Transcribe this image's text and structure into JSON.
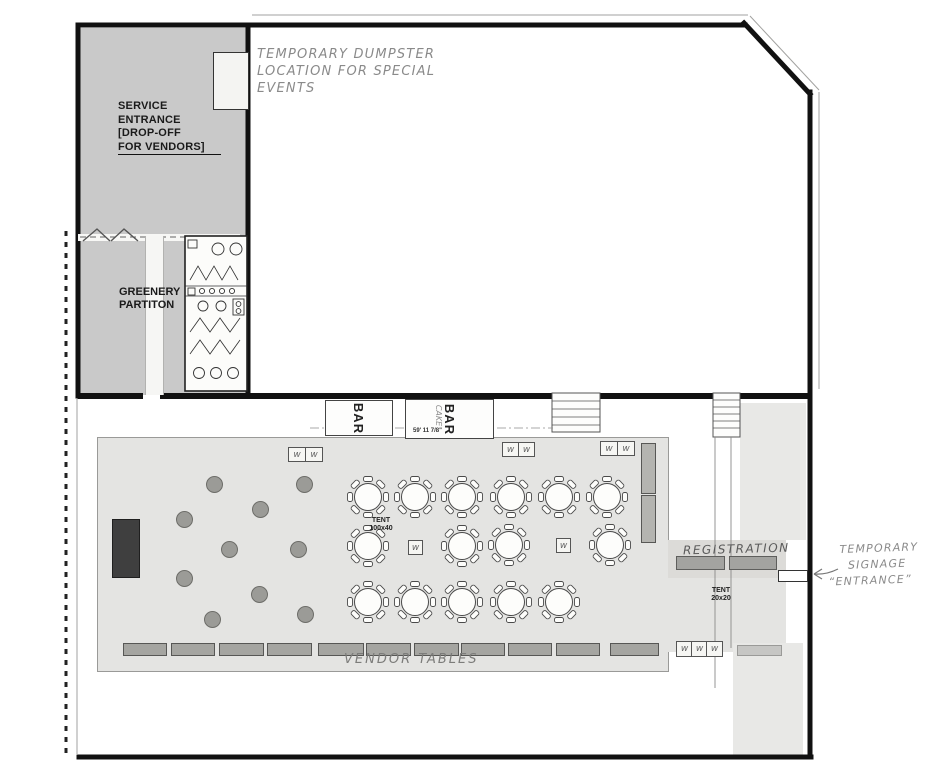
{
  "labels": {
    "service_entrance_lines": [
      "SERVICE",
      "ENTRANCE",
      "[DROP-OFF",
      "FOR VENDORS]"
    ],
    "greenery_lines": [
      "GREENERY",
      "PARTITON"
    ],
    "dumpster_note_lines": [
      "TEMPORARY DUMPSTER",
      "LOCATION FOR SPECIAL",
      "EVENTS"
    ],
    "bar_left": "BAR",
    "bar_right": "BAR",
    "cake_note": "CAKE",
    "bar_dimension": "59' 11 7/8\"",
    "tent_main_lines": [
      "TENT",
      "100x40"
    ],
    "tent_small_lines": [
      "TENT",
      "20x20"
    ],
    "registration": "REGISTRATION",
    "vendor_tables": "VENDOR TABLES",
    "signage_note_lines": [
      "TEMPORARY",
      "SIGNAGE",
      "“ENTRANCE”"
    ],
    "w_marker": "w"
  },
  "colors": {
    "paper": "#ffffff",
    "outline": "#111111",
    "zone_dark_gray": "#c9c9c9",
    "zone_light_gray": "#e4e4e2",
    "pencil": "#8a8a8a",
    "table_gray": "#a5a5a1",
    "stage_fill": "#3f3f3f"
  },
  "layout": {
    "cocktail_tables": [
      [
        213,
        483
      ],
      [
        303,
        483
      ],
      [
        259,
        508
      ],
      [
        183,
        518
      ],
      [
        228,
        548
      ],
      [
        297,
        548
      ],
      [
        183,
        577
      ],
      [
        258,
        593
      ],
      [
        211,
        618
      ],
      [
        304,
        613
      ]
    ],
    "dining_tables": [
      [
        368,
        497
      ],
      [
        415,
        497
      ],
      [
        462,
        497
      ],
      [
        511,
        497
      ],
      [
        559,
        497
      ],
      [
        607,
        497
      ],
      [
        368,
        546
      ],
      [
        462,
        546
      ],
      [
        509,
        545
      ],
      [
        610,
        545
      ],
      [
        368,
        602
      ],
      [
        415,
        602
      ],
      [
        462,
        602
      ],
      [
        511,
        602
      ],
      [
        559,
        602
      ]
    ],
    "vendor_tables": [
      [
        123,
        643,
        42,
        11
      ],
      [
        171,
        643,
        42,
        11
      ],
      [
        219,
        643,
        43,
        11
      ],
      [
        267,
        643,
        43,
        11
      ],
      [
        318,
        643,
        44,
        11
      ],
      [
        366,
        643,
        43,
        11
      ],
      [
        414,
        643,
        43,
        11
      ],
      [
        461,
        643,
        42,
        11
      ],
      [
        508,
        643,
        42,
        11
      ],
      [
        556,
        643,
        42,
        11
      ],
      [
        610,
        643,
        47,
        11
      ]
    ],
    "w_boxes": [
      [
        288,
        447,
        16,
        13
      ],
      [
        305,
        447,
        16,
        13
      ],
      [
        502,
        442,
        15,
        13
      ],
      [
        518,
        442,
        15,
        13
      ],
      [
        600,
        441,
        16,
        13
      ],
      [
        617,
        441,
        16,
        13
      ],
      [
        408,
        540,
        13,
        13
      ],
      [
        556,
        538,
        13,
        13
      ],
      [
        676,
        641,
        15,
        14
      ],
      [
        691,
        641,
        15,
        14
      ],
      [
        706,
        641,
        15,
        14
      ]
    ],
    "registration_tables": [
      [
        676,
        556,
        47,
        12
      ],
      [
        729,
        556,
        46,
        12
      ]
    ],
    "side_strips": [
      [
        641,
        443,
        13,
        49
      ],
      [
        641,
        495,
        13,
        46
      ]
    ],
    "extra_strip": [
      737,
      645,
      43,
      9
    ],
    "stage": [
      112,
      519,
      26,
      57
    ]
  }
}
